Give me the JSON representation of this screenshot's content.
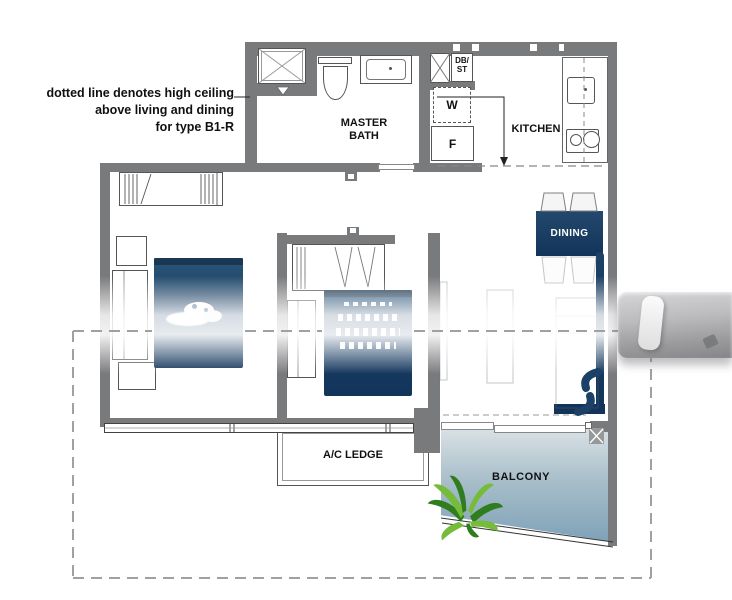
{
  "annotation": {
    "line1": "dotted line denotes high ceiling",
    "line2": "above living and dining",
    "line3": "for type B1-R"
  },
  "rooms": {
    "master_bath": {
      "label_line1": "MASTER",
      "label_line2": "BATH"
    },
    "kitchen": {
      "label": "KITCHEN"
    },
    "dining": {
      "label": "DINING"
    },
    "ac_ledge": {
      "label": "A/C LEDGE"
    },
    "balcony": {
      "label": "BALCONY"
    }
  },
  "fixtures": {
    "distribution_board": {
      "line1": "DB/",
      "line2": "ST"
    },
    "washer": {
      "label": "W"
    },
    "fridge": {
      "label": "F"
    }
  },
  "colors": {
    "wall": "#797a7c",
    "navy": "#1c4166",
    "navy_deep": "#12345a",
    "balcony_top": "#d9e1e5",
    "balcony_bottom": "#7fa2b8",
    "plant_light": "#76bb3a",
    "plant_dark": "#2f7d1f",
    "dash": "#9fa0a2"
  }
}
